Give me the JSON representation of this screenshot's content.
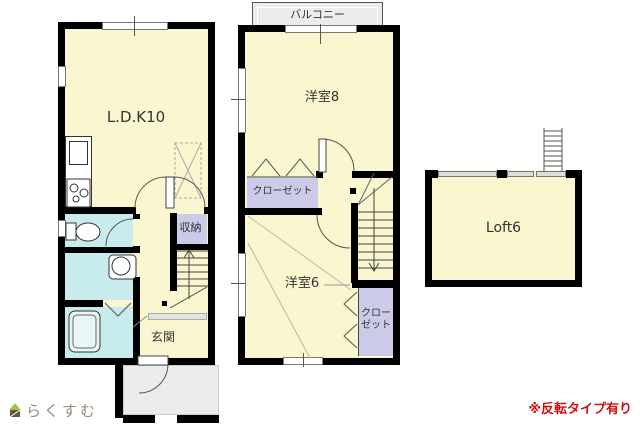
{
  "floor1": {
    "ldk_label": "L.D.K10",
    "storage_label": "収納",
    "entrance_label": "玄関"
  },
  "floor2": {
    "balcony_label": "バルコニー",
    "bedroom8_label": "洋室8",
    "closet_left_label": "クローゼット",
    "bedroom6_label": "洋室6",
    "closet_right_label": "クローゼット"
  },
  "loft": {
    "label": "Loft6"
  },
  "footer": {
    "brand": "らくすむ",
    "note": "※反転タイプ有り"
  },
  "colors": {
    "room_yellow": "#faf6d0",
    "wet_area_cyan": "#c8ebee",
    "closet_purple": "#cbcbe9",
    "wall_black": "#000000",
    "outdoor_gray": "#ececec",
    "note_red": "#d01010",
    "brand_brown": "#9a8a7a"
  }
}
